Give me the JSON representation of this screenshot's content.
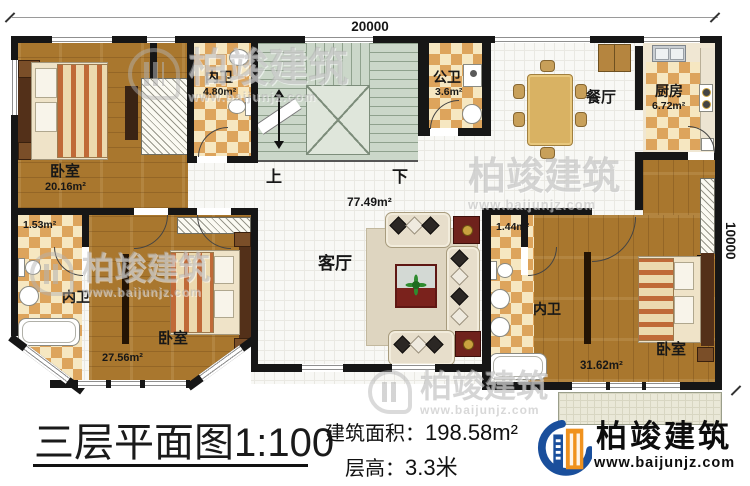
{
  "plan": {
    "dim_top": "20000",
    "dim_right": "10000",
    "stairs_up": "上",
    "stairs_down": "下",
    "rooms": {
      "bedroom_tl": {
        "label": "卧室",
        "area": "20.16m²"
      },
      "bath_tl": {
        "label": "内卫",
        "area": "4.80m²"
      },
      "public_bath": {
        "label": "公卫",
        "area": "3.6m²"
      },
      "dining": {
        "label": "餐厅"
      },
      "kitchen": {
        "label": "厨房",
        "area": "6.72m²"
      },
      "living": {
        "label": "客厅",
        "area": "77.49m²"
      },
      "bath_ml": {
        "label": "内卫",
        "area": "1.53m²"
      },
      "bedroom_bl": {
        "label": "卧室",
        "area": "27.56m²"
      },
      "bath_mr": {
        "label": "内卫",
        "area": "1.44m²"
      },
      "bedroom_br": {
        "label": "卧室",
        "area": "31.62m²"
      }
    }
  },
  "title_block": {
    "title": "三层平面图",
    "scale": "1:100",
    "area_label": "建筑面积：",
    "area_value": "198.58m²",
    "floor_height_label": "层高：",
    "floor_height_value": "3.3米"
  },
  "logo": {
    "name": "柏竣建筑",
    "url": "www.baijunjz.com"
  },
  "watermark": {
    "name": "柏竣建筑",
    "url": "www.baijunjz.com"
  },
  "colors": {
    "wall": "#161616",
    "wood": "#a9772e",
    "checker_tan": "#dda45c",
    "stairs_green": "#cbd7c9",
    "logo_blue": "#1a4f9c",
    "logo_orange": "#f0921e"
  }
}
